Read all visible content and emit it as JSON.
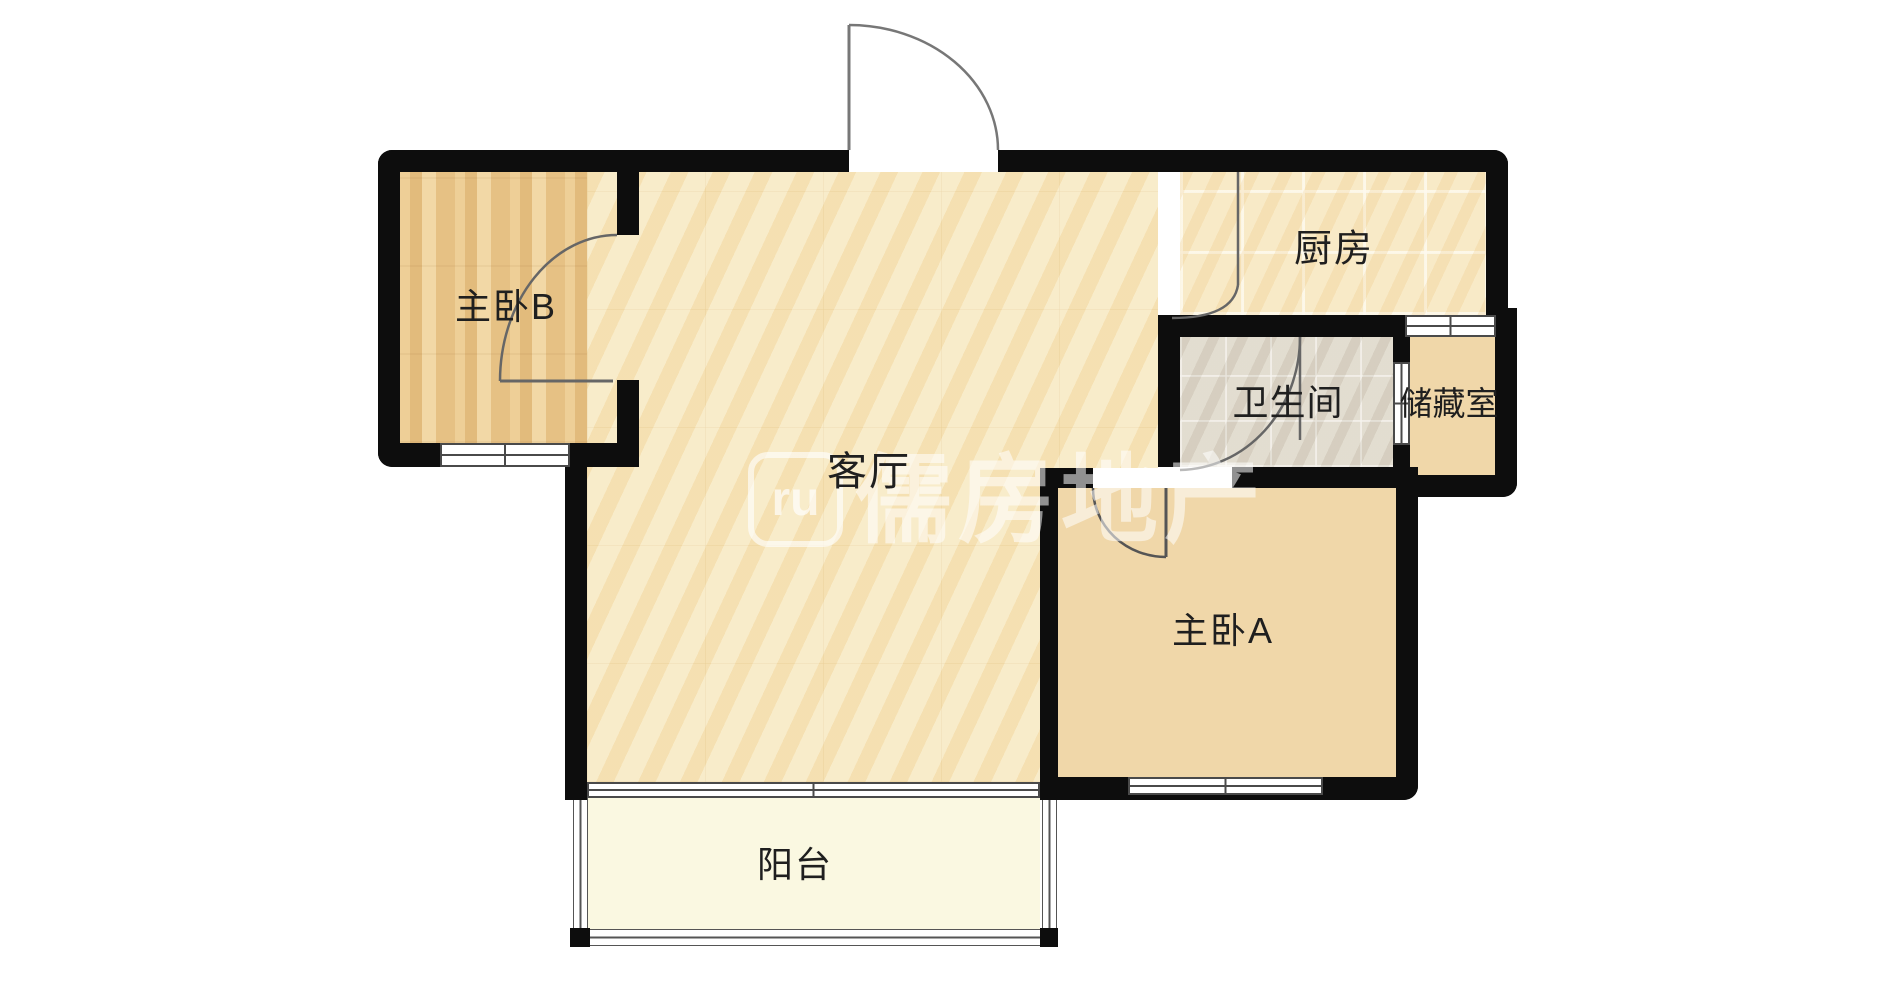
{
  "title": "户型图",
  "rooms": [
    {
      "id": "bedroom-b",
      "label": "主卧B",
      "floor": "wood"
    },
    {
      "id": "living-room",
      "label": "客厅",
      "floor": "marble"
    },
    {
      "id": "kitchen",
      "label": "厨房",
      "floor": "tile"
    },
    {
      "id": "bathroom",
      "label": "卫生间",
      "floor": "tile-gray"
    },
    {
      "id": "storage",
      "label": "储藏室",
      "floor": "wood"
    },
    {
      "id": "bedroom-a",
      "label": "主卧A",
      "floor": "wood"
    },
    {
      "id": "balcony",
      "label": "阳台",
      "floor": "plain"
    }
  ],
  "watermark": {
    "logo": "ru",
    "text": "儒房地产"
  },
  "palette": {
    "wall": "#0d0d0d",
    "living_floor": "#f7e8c3",
    "kitchen_tile": "#f6e4bd",
    "bath_tile": "#d9d3c5",
    "wood_warm": "#e6c184",
    "wood_light": "#f0d7a9",
    "balcony": "#faf8e1",
    "watermark_white": "#ffffff",
    "background": "#ffffff"
  }
}
